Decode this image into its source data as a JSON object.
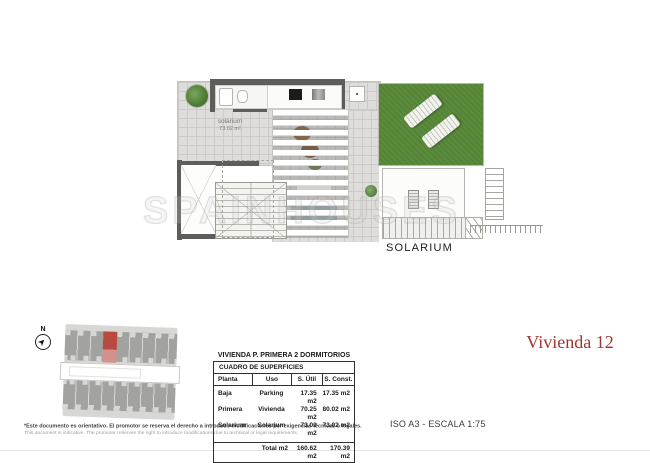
{
  "plan": {
    "room_label": "solarium",
    "room_area": "73.02 m²",
    "caption": "SOLARIUM"
  },
  "watermark": {
    "text": "SPAINHOUSES"
  },
  "site": {
    "north_label": "N"
  },
  "table": {
    "title": "VIVIENDA P. PRIMERA 2 DORMITORIOS",
    "subtitle": "CUADRO DE SUPERFICIES",
    "headers": [
      "Planta",
      "Uso",
      "S. Útil",
      "S. Const."
    ],
    "rows": [
      [
        "Baja",
        "Parking",
        "17.35 m2",
        "17.35 m2"
      ],
      [
        "Primera",
        "Vivienda",
        "70.25 m2",
        "80.02 m2"
      ],
      [
        "Solarium",
        "Solarium",
        "73.02 m2",
        "73.02 m2"
      ]
    ],
    "total": {
      "label": "Total m2",
      "util": "160.62 m2",
      "const": "170.39 m2"
    }
  },
  "titles": {
    "unit": "Vivienda 12",
    "scale": "ISO A3 - ESCALA 1:75"
  },
  "footer": {
    "disclaimer_es": "*Este documento es orientativo. El promotor se reserva el derecho a introducir modificaciones por exigencias técnicas o legales.",
    "disclaimer_en": "This document is indicative. The promoter reserves the right to introduce modifications due to technical or legal requirements."
  },
  "colors": {
    "accent_red": "#a2352b",
    "highlight_red": "#b84a42",
    "grass_green": "#5a8c3c",
    "wall_gray": "#5d5d5b"
  }
}
